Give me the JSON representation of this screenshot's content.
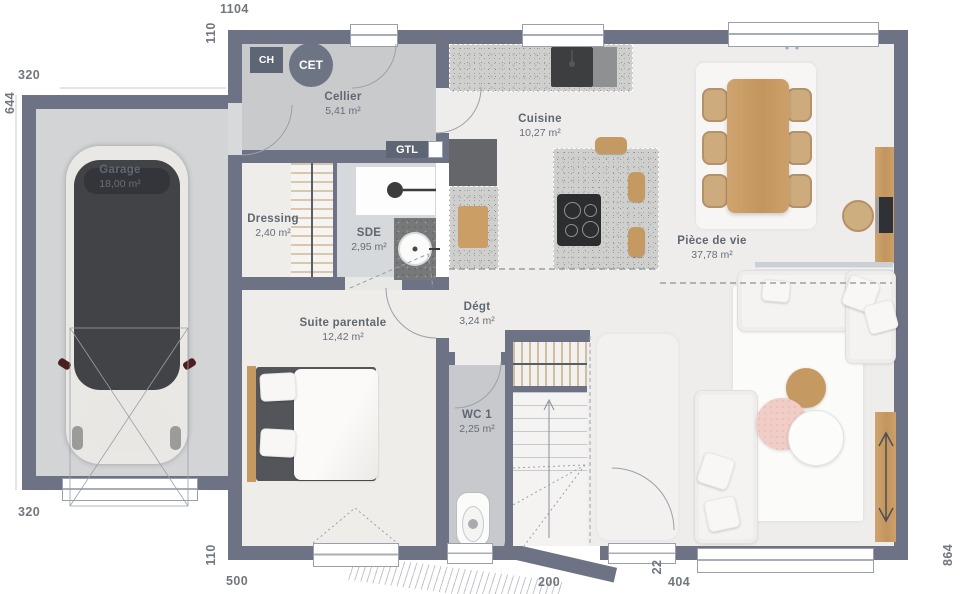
{
  "plan": {
    "rooms": {
      "garage": {
        "name": "Garage",
        "area": "18,00 m²"
      },
      "cellier": {
        "name": "Cellier",
        "area": "5,41 m²"
      },
      "cuisine": {
        "name": "Cuisine",
        "area": "10,27 m²"
      },
      "dressing": {
        "name": "Dressing",
        "area": "2,40 m²"
      },
      "sde": {
        "name": "SDE",
        "area": "2,95 m²"
      },
      "suite_parentale": {
        "name": "Suite parentale",
        "area": "12,42 m²"
      },
      "degagement": {
        "name": "Dégt",
        "area": "3,24 m²"
      },
      "wc": {
        "name": "WC 1",
        "area": "2,25 m²"
      },
      "piece_de_vie": {
        "name": "Pièce de vie",
        "area": "37,78 m²"
      }
    },
    "equipment_tags": {
      "ch": "CH",
      "cet": "CET",
      "gtl": "GTL"
    },
    "dimensions_cm": {
      "top_width": "1104",
      "top_offset": "110",
      "garage_top": "320",
      "garage_left": "644",
      "garage_bottom": "320",
      "bottom_offset": "110",
      "bottom_seg1": "500",
      "bottom_seg2": "200",
      "bottom_seg3": "22",
      "bottom_seg4": "404",
      "right_height": "864"
    },
    "colors": {
      "wall": "#6d7384",
      "floor-main": "#efedea",
      "floor-garage": "#d3d4d6",
      "floor-wet": "#d6d9db",
      "wood": "#c59a62"
    }
  }
}
